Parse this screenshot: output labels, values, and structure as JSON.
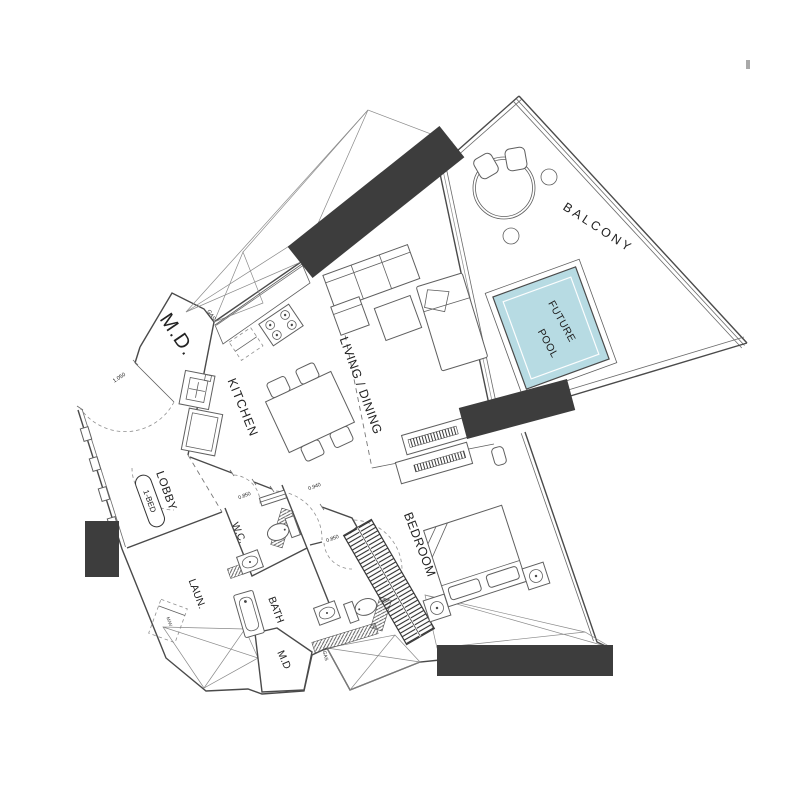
{
  "title": "apartment-floor-plan",
  "colors": {
    "pool": "#b7dbe3",
    "highlight": "#3d3d3d"
  },
  "rooms": {
    "md_upper": "M.D.",
    "kitchen": "KITCHEN",
    "living_dining": "LIVING / DINING",
    "lobby": "LOBBY",
    "laundry": "LAUN.",
    "wc": "W.C.",
    "bath": "BATH",
    "md_lower": "M.D",
    "bedroom": "BEDROOM",
    "balcony": "BALCONY",
    "future_pool_line1": "FUTURE",
    "future_pool_line2": "POOL"
  },
  "badge": {
    "label": "1-BED"
  },
  "annotations": {
    "gas_upper": "GAS",
    "gas_lower": "GAS",
    "washer": "M/W"
  },
  "dimensions": {
    "entry_door": "1.050",
    "wc_door": "0.850",
    "bedroom_door": "0.940",
    "ensuite_door": "0.850"
  }
}
